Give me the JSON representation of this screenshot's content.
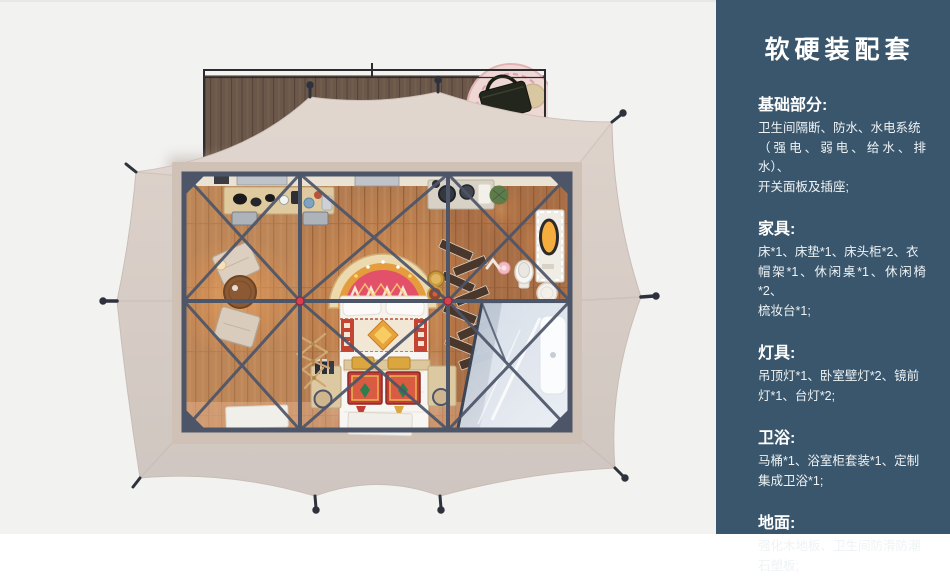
{
  "panel": {
    "title": "软硬装配套",
    "sections": [
      {
        "heading": "基础部分:",
        "body": "卫生间隔断、防水、水电系统\n（强电、弱电、给水、排水）、\n开关面板及插座;"
      },
      {
        "heading": "家具:",
        "body": "床*1、床垫*1、床头柜*2、衣\n帽架*1、休闲桌*1、休闲椅*2、\n梳妆台*1;"
      },
      {
        "heading": "灯具:",
        "body": "吊顶灯*1、卧室壁灯*2、镜前\n灯*1、台灯*2;"
      },
      {
        "heading": "卫浴:",
        "body": "马桶*1、浴室柜套装*1、定制\n集成卫浴*1;"
      },
      {
        "heading": "地面:",
        "body": "强化木地板、卫生间防滑防潮\n石塑板;"
      }
    ]
  },
  "scene": {
    "description": "帐篷客房顶视平面渲染图：木平台、帐篷篷布、钢框架、床、休闲区、梳妆区与淋浴卫浴间"
  },
  "colors": {
    "panel_bg": "#3a566c",
    "canvas_bg": "#f2f2f1",
    "tent_fabric": "#d8cdc6",
    "frame_steel": "#4d5569",
    "floor_wood": "#b37c50",
    "deck_wood": "#6b584a",
    "accent_red": "#d8404e",
    "glass_blue": "#ccd7e4"
  }
}
